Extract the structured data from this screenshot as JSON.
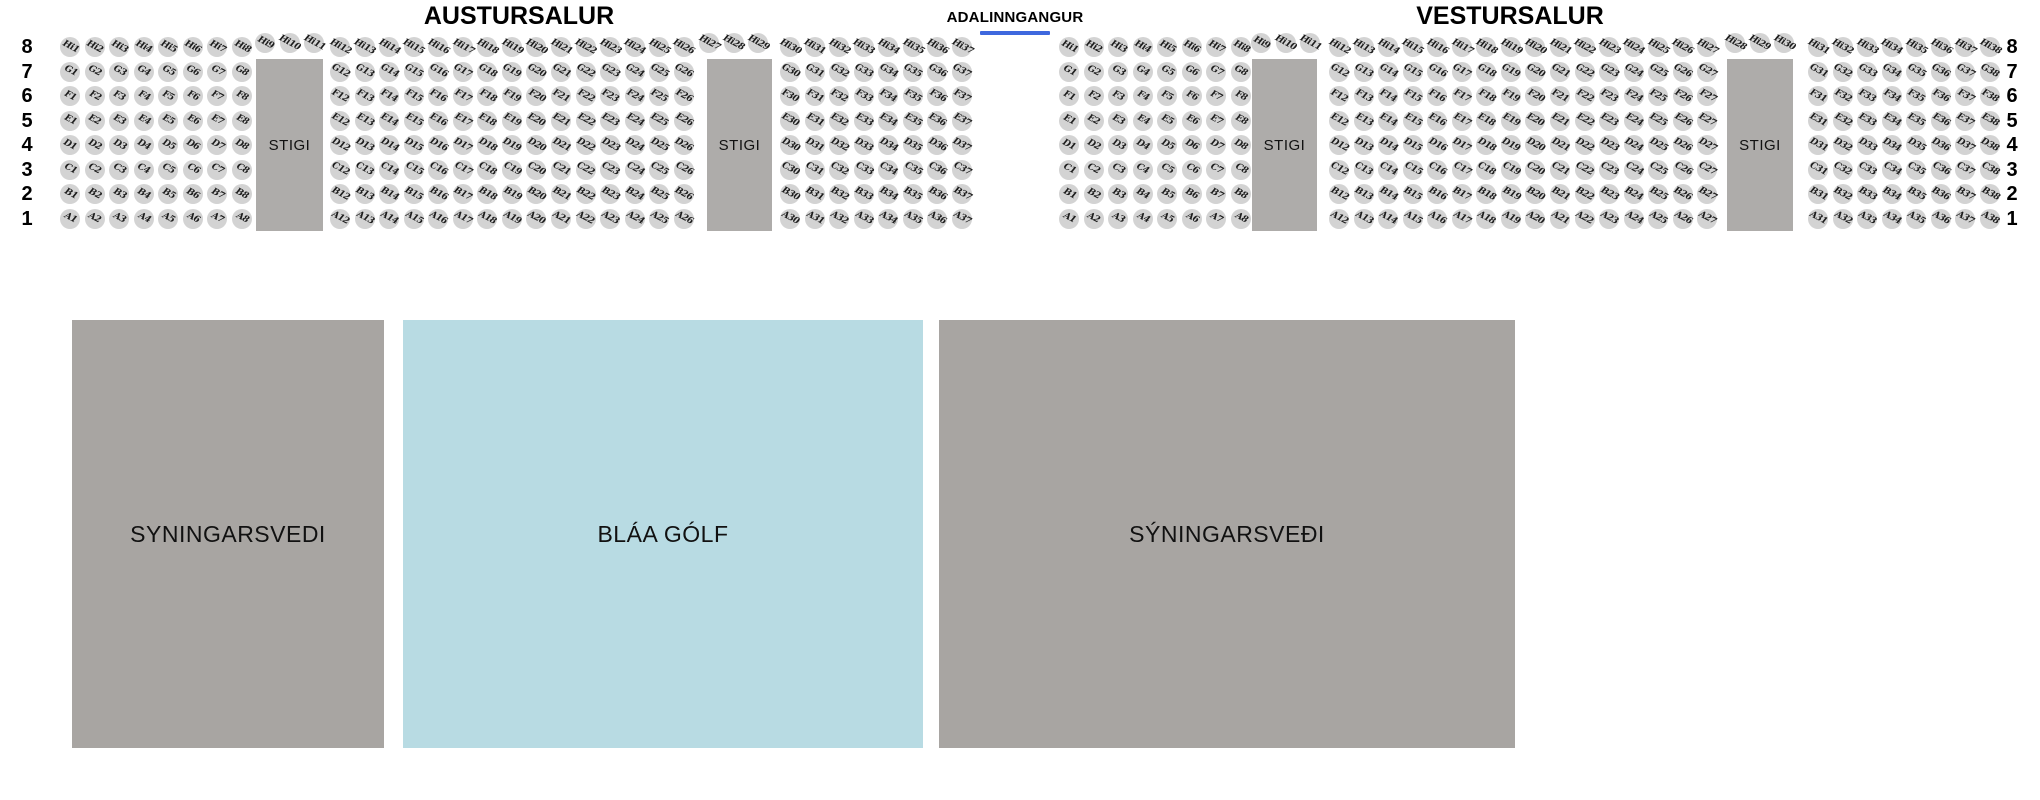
{
  "titles": {
    "east_hall": "AUSTURSALUR",
    "main_entrance": "ADALINNGANGUR",
    "west_hall": "VESTURSALUR"
  },
  "entrance": {
    "underline_color": "#3e68de",
    "underline_x": 980,
    "underline_y": 31,
    "underline_w": 70
  },
  "stigi_label": "STIGI",
  "colors": {
    "seat_fill": "#d3d3d3",
    "seat_text": "#1c1c1c",
    "stigi_fill": "#aeacaa",
    "area_gray": "#a8a5a2",
    "area_blue": "#b8dbe3",
    "background": "#ffffff"
  },
  "seatmap": {
    "row_numbers_top_to_bottom": [
      "8",
      "7",
      "6",
      "5",
      "4",
      "3",
      "2",
      "1"
    ],
    "row_letters_top_to_bottom": [
      "Hi",
      "G",
      "F",
      "E",
      "D",
      "C",
      "B",
      "A"
    ],
    "first_row_center_y": 47,
    "row_pitch": 24.5,
    "seat_pitch": 24.55,
    "seat_diameter": 20,
    "left_row_label_x": 27,
    "right_row_label_x": 2012,
    "salons": [
      {
        "name": "austursalur",
        "stigi_blocks": [
          {
            "x": 256,
            "y": 59,
            "w": 67,
            "h": 172
          },
          {
            "x": 707,
            "y": 59,
            "w": 65,
            "h": 172
          }
        ],
        "seat_groups_row_8": [
          {
            "start_seat": 1,
            "count": 8,
            "first_center_x": 70
          },
          {
            "start_seat": 9,
            "count": 3,
            "first_center_x": 265,
            "dy": -4
          },
          {
            "start_seat": 12,
            "count": 15,
            "first_center_x": 340
          },
          {
            "start_seat": 27,
            "count": 3,
            "first_center_x": 709,
            "dy": -4
          },
          {
            "start_seat": 30,
            "count": 8,
            "first_center_x": 790
          }
        ],
        "seat_groups_rows_1_7": [
          {
            "start_seat": 1,
            "count": 8,
            "first_center_x": 70
          },
          {
            "start_seat": 12,
            "count": 15,
            "first_center_x": 340
          },
          {
            "start_seat": 30,
            "count": 8,
            "first_center_x": 790
          }
        ]
      },
      {
        "name": "vestursalur",
        "stigi_blocks": [
          {
            "x": 1252,
            "y": 59,
            "w": 65,
            "h": 172
          },
          {
            "x": 1727,
            "y": 59,
            "w": 66,
            "h": 172
          }
        ],
        "seat_groups_row_8": [
          {
            "start_seat": 1,
            "count": 8,
            "first_center_x": 1069
          },
          {
            "start_seat": 9,
            "count": 3,
            "first_center_x": 1261,
            "dy": -4
          },
          {
            "start_seat": 12,
            "count": 16,
            "first_center_x": 1339
          },
          {
            "start_seat": 28,
            "count": 3,
            "first_center_x": 1735,
            "dy": -4
          },
          {
            "start_seat": 31,
            "count": 8,
            "first_center_x": 1818
          }
        ],
        "seat_groups_rows_1_7": [
          {
            "start_seat": 1,
            "count": 8,
            "first_center_x": 1069
          },
          {
            "start_seat": 12,
            "count": 16,
            "first_center_x": 1339
          },
          {
            "start_seat": 31,
            "count": 8,
            "first_center_x": 1818
          }
        ]
      }
    ]
  },
  "areas": [
    {
      "name": "syningarsvedi-left",
      "label": "SYNINGARSVEDI",
      "x": 72,
      "y": 320,
      "w": 312,
      "h": 428,
      "color": "#a8a5a2",
      "interactable": false
    },
    {
      "name": "blaa-golf",
      "label": "BLÁA GÓLF",
      "x": 403,
      "y": 320,
      "w": 520,
      "h": 428,
      "color": "#b8dbe3",
      "interactable": true
    },
    {
      "name": "syningarsvedi-right",
      "label": "SÝNINGARSVEÐI",
      "x": 939,
      "y": 320,
      "w": 576,
      "h": 428,
      "color": "#a8a5a2",
      "interactable": false
    }
  ]
}
